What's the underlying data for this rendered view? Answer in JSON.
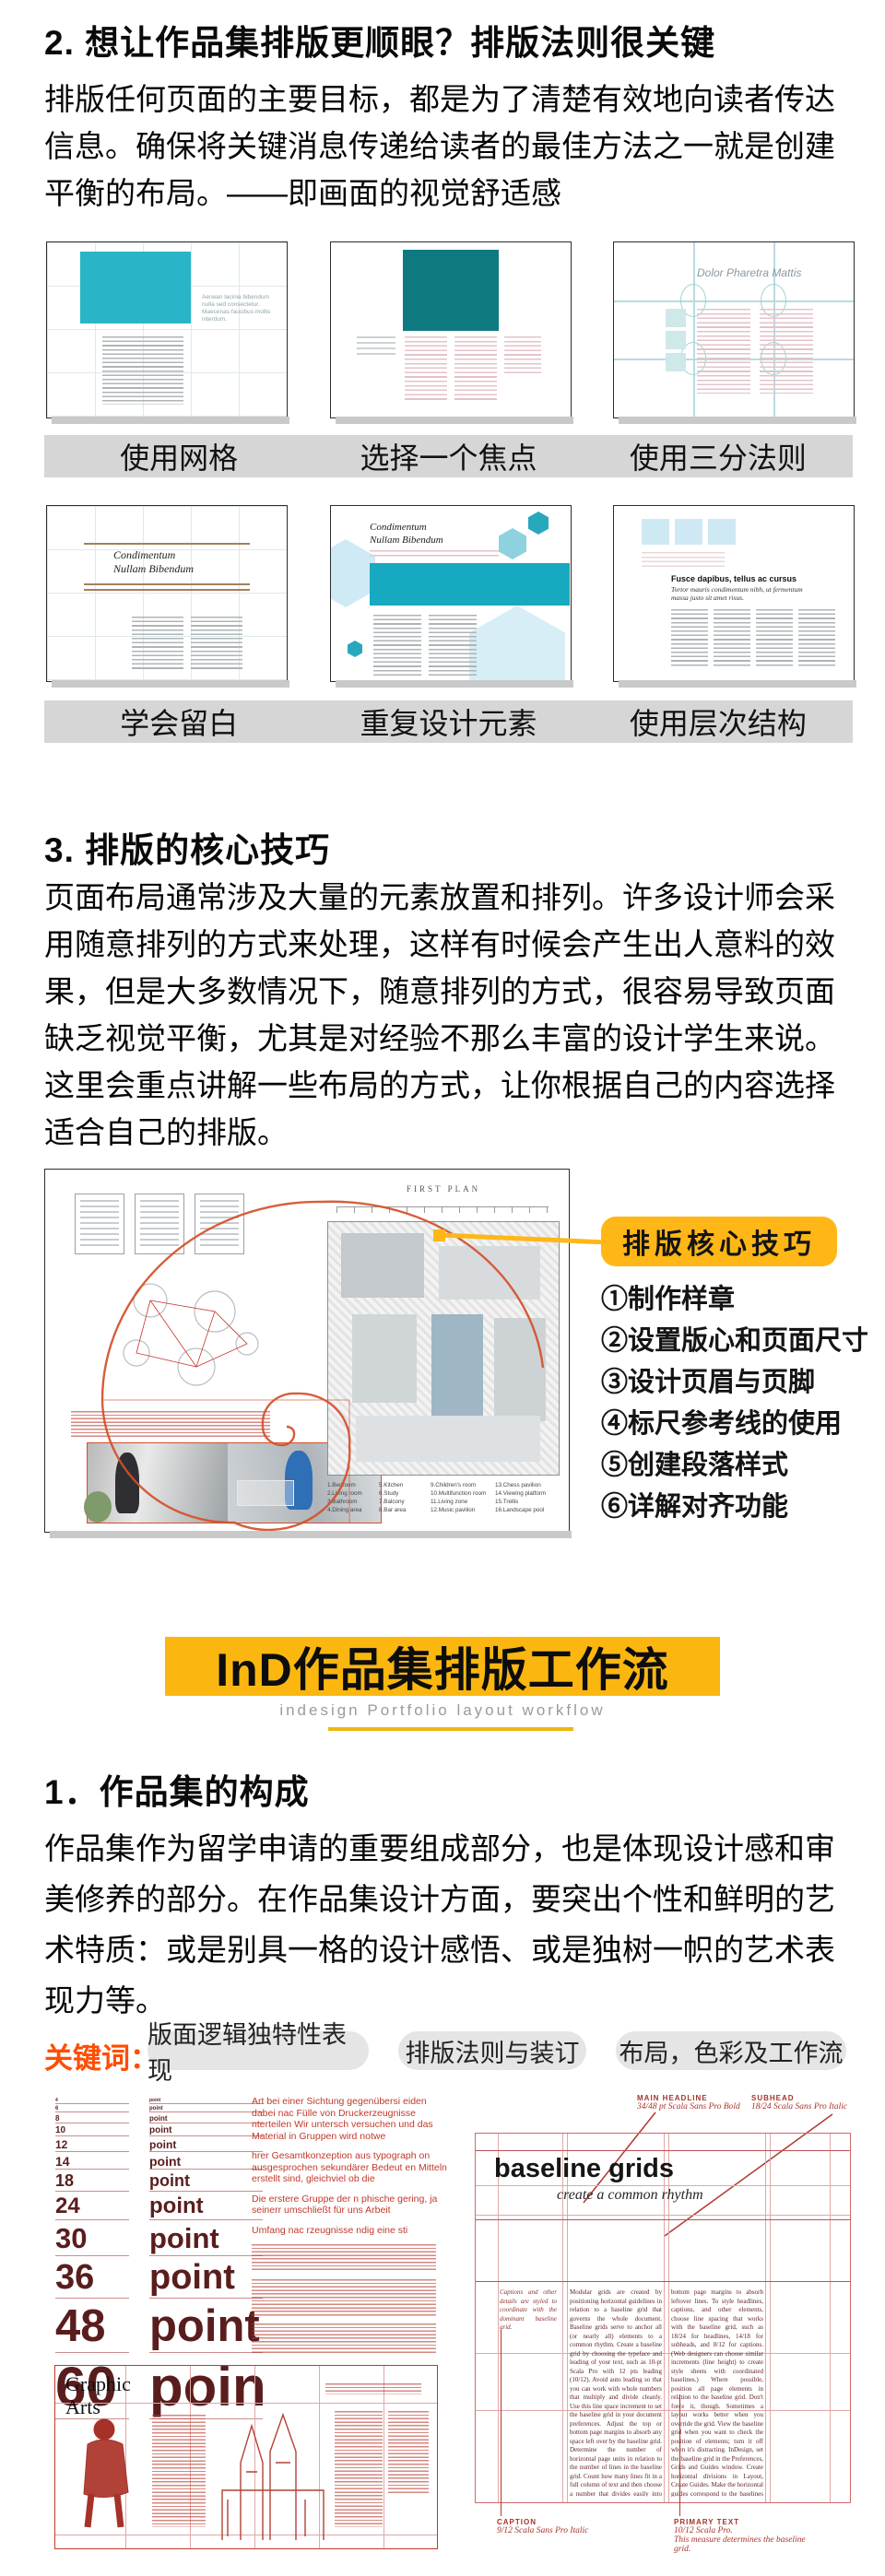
{
  "accent_colors": {
    "yellow": "#FFB717",
    "banner_yellow": "#FBB70F",
    "teal": "#2AB4C7",
    "dark_teal": "#0E7A80",
    "orange": "#FF4D00",
    "red": "#C0392B",
    "maroon": "#5A1D1D",
    "caption_band": "#D6D6D6"
  },
  "section2": {
    "heading": "2. 想让作品集排版更顺眼？排版法则很关键",
    "paragraph": "排版任何页面的主要目标，都是为了清楚有效地向读者传达信息。确保将关键消息传递给读者的最佳方法之一就是创建平衡的布局。——即画面的视觉舒适感"
  },
  "gallery": {
    "captions": [
      "使用网格",
      "选择一个焦点",
      "使用三分法则",
      "学会留白",
      "重复设计元素",
      "使用层次结构"
    ],
    "thumb1_text": "Aenean lacinia bibendum nulla sed consectetur. Maecenas faucibus mollis interdum.",
    "thumb3_title": "Dolor Pharetra Mattis",
    "thumb4_title_line1": "Condimentum",
    "thumb4_title_line2": "Nullam Bibendum",
    "thumb5_title_line1": "Condimentum",
    "thumb5_title_line2": "Nullam Bibendum",
    "thumb6_heading": "Fusce dapibus, tellus ac cursus",
    "thumb6_subhead": "Tortor mauris condimentum nibh, ut fermentum massa justo sit amet risus."
  },
  "section3": {
    "heading": "3. 排版的核心技巧",
    "paragraph": "页面布局通常涉及大量的元素放置和排列。许多设计师会采用随意排列的方式来处理，这样有时候会产生出人意料的效果，但是大多数情况下，随意排列的方式，很容易导致页面缺乏视觉平衡，尤其是对经验不那么丰富的设计学生来说。这里会重点讲解一些布局的方式，让你根据自己的内容选择适合自己的排版。",
    "figure": {
      "plan_label": "FIRST PLAN",
      "legend": [
        "1.Bedroom",
        "2.Living room",
        "3.Bathroom",
        "4.Dining area",
        "5.Kitchen",
        "6.Study",
        "7.Balcony",
        "8.Bar area",
        "9.Children's room",
        "10.Multifunction room",
        "11.Living zone",
        "12.Music pavilion",
        "13.Chess pavilion",
        "14.Viewing platform",
        "15.Trellis",
        "16.Landscape pool"
      ],
      "callout": "排版核心技巧",
      "tips": [
        "①制作样章",
        "②设置版心和页面尺寸",
        "③设计页眉与页脚",
        "④标尺参考线的使用",
        "⑤创建段落样式",
        "⑥详解对齐功能"
      ]
    }
  },
  "banner": {
    "title": "InD作品集排版工作流",
    "subtitle": "indesign Portfolio layout workflow"
  },
  "section1": {
    "heading": "1．作品集的构成",
    "paragraph": "作品集作为留学申请的重要组成部分，也是体现设计感和审美修养的部分。在作品集设计方面，要突出个性和鲜明的艺术特质：或是别具一格的设计感悟、或是独树一帜的艺术表现力等。",
    "keywords_label": "关键词：",
    "keywords": [
      "版面逻辑独特性表现",
      "排版法则与装订",
      "布局，色彩及工作流"
    ]
  },
  "bottom": {
    "point_sizes": [
      "4",
      "6",
      "8",
      "10",
      "12",
      "14",
      "18",
      "24",
      "30",
      "36",
      "48",
      "60"
    ],
    "point_label": "point",
    "german": {
      "p1": "Art bei einer Sichtung gegenübersi eiden dabei nac Fülle von Druckerzeugnisse nterteilen Wir untersch versuchen und das Material in Gruppen wird notwe",
      "p2": "hrer Gesamtkonzeption aus typograph on ausgesprochen sekundärer Bedeut en Mitteln erstellt sind, gleichviel ob die",
      "p3": "Die erstere Gruppe der n phische gering, ja seinerr umschließt für uns Arbeit",
      "p4": "Umfang nac rzeugnisse ndig eine sti"
    },
    "graphic_arts_title_line1": "Graphic",
    "graphic_arts_title_line2": "Arts",
    "baseline": {
      "main_headline_label": "MAIN HEADLINE",
      "main_headline_spec": "34/48 pt Scala Sans Pro Bold",
      "subhead_label": "SUBHEAD",
      "subhead_spec": "18/24 Scala Sans Pro Italic",
      "title": "baseline grids",
      "subtitle": "create a common rhythm",
      "col_caption": "Captions and other details are styled to coordinate with the dominant baseline grid.",
      "col_mid": "Modular grids are created by positioning horizontal guidelines in relation to a baseline grid that governs the whole document. Baseline grids serve to anchor all (or nearly all) elements to a common rhythm. Create a baseline grid by choosing the typeface and leading of your text, such as 10-pt Scala Pro with 12 pts leading (10/12). Avoid auto leading so that you can work with whole numbers that multiply and divide cleanly. Use this line space increment to set the baseline grid in your document preferences. Adjust the top or bottom page margins to absorb any space left over by the baseline grid. Determine the number of horizontal page units in relation to the number of lines in the baseline grid. Count how many lines fit in a full column of text and then choose a number that divides easily into the line count to create horizontal page divisions. A column with forty-two lines of text divides neatly into seven horizontal modules with six lines each. If your line count is not neatly divisible, adjust the top and/or",
      "col_right": "bottom page margins to absorb leftover lines. To style headlines, captions, and other elements, choose line spacing that works with the baseline grid, such as 18/24 for headlines, 14/18 for subheads, and 8/12 for captions. (Web designers can choose similar increments (line height) to create style sheets with coordinated baselines.) Where possible, position all page elements in relation to the baseline grid. Don't force it, though. Sometimes a layout works better when you override the grid. View the baseline grid when you want to check the position of elements; turn it off when it's distracting. InDesign, set the baseline grid in the Preferences, Grids and Guides window. Create horizontal divisions in Layout, Create Guides. Make the horizontal guides correspond to the baselines of the page's primary text by choosing a number of rows that divides evenly into the number of lines in a full column of text. Working in InDesign, you can make",
      "caption_label": "CAPTION",
      "caption_spec": "9/12 Scala Sans Pro Italic",
      "primary_label": "PRIMARY TEXT",
      "primary_spec": "10/12 Scala Pro.",
      "primary_note": "This measure determines the baseline grid."
    }
  }
}
